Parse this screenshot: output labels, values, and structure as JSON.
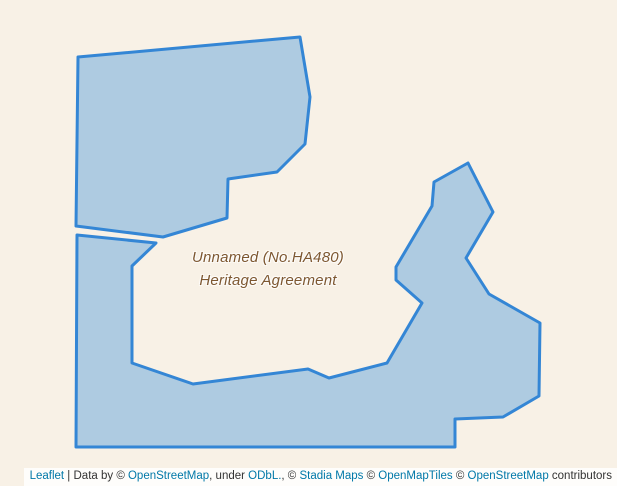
{
  "map": {
    "background_color": "#f8f1e6",
    "label": {
      "line1": "Unnamed (No.HA480)",
      "line2": "Heritage Agreement",
      "color": "#7d5730"
    },
    "polygons": {
      "stroke_color": "#3486d5",
      "fill_color": "#aecbe1",
      "north_polygon_points": "78,57 300,37 310,97 305,144 277,172 228,179 227,218 163,237 76,226",
      "south_polygon_points": "77,235 156,243 132,266 132,363 193,384 308,369 329,378 387,363 422,303 396,280 396,267 432,206 434,182 468,163 493,212 466,258 489,294 540,323 539,396 503,417 455,419 455,447 76,447"
    }
  },
  "attribution": {
    "background_color": "rgba(255,255,255,0.82)",
    "link_color": "#0078a8",
    "text_color": "#333333",
    "segments": [
      {
        "text": "Leaflet",
        "link": true
      },
      {
        "text": " | Data by © ",
        "link": false
      },
      {
        "text": "OpenStreetMap",
        "link": true
      },
      {
        "text": ", under ",
        "link": false
      },
      {
        "text": "ODbL.",
        "link": true
      },
      {
        "text": ", © ",
        "link": false
      },
      {
        "text": "Stadia Maps",
        "link": true
      },
      {
        "text": " © ",
        "link": false
      },
      {
        "text": "OpenMapTiles",
        "link": true
      },
      {
        "text": " © ",
        "link": false
      },
      {
        "text": "OpenStreetMap",
        "link": true
      },
      {
        "text": " contributors",
        "link": false
      }
    ]
  }
}
